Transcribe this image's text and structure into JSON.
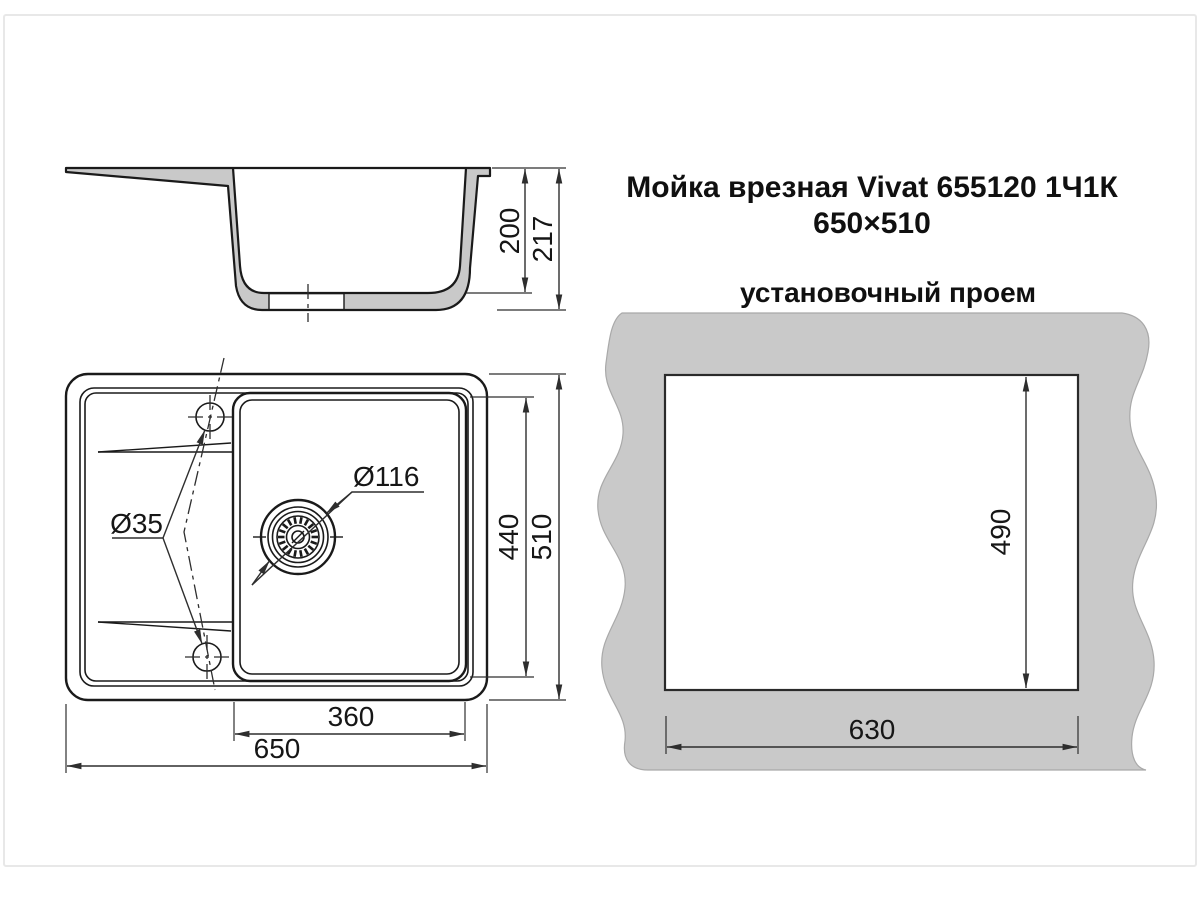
{
  "title": {
    "line1": "Мойка врезная Vivat 655120 1Ч1К",
    "line2": "650×510"
  },
  "opening": {
    "label": "установочный проем",
    "cutout_height": "490",
    "cutout_width": "630"
  },
  "section": {
    "inner_depth": "200",
    "total_height": "217"
  },
  "plan": {
    "bowl_width": "360",
    "total_width": "650",
    "bowl_length": "440",
    "total_length": "510",
    "faucet_hole_d": "Ø35",
    "drain_d": "Ø116"
  },
  "style": {
    "line_color": "#1a1a1a",
    "dim_color": "#2e2e2e",
    "section_fill_gray": "#c9c9c9",
    "panel_gray": "#c9c9c9",
    "panel_edge": "#a9a9a9",
    "card_border": "#e8e8e8"
  }
}
